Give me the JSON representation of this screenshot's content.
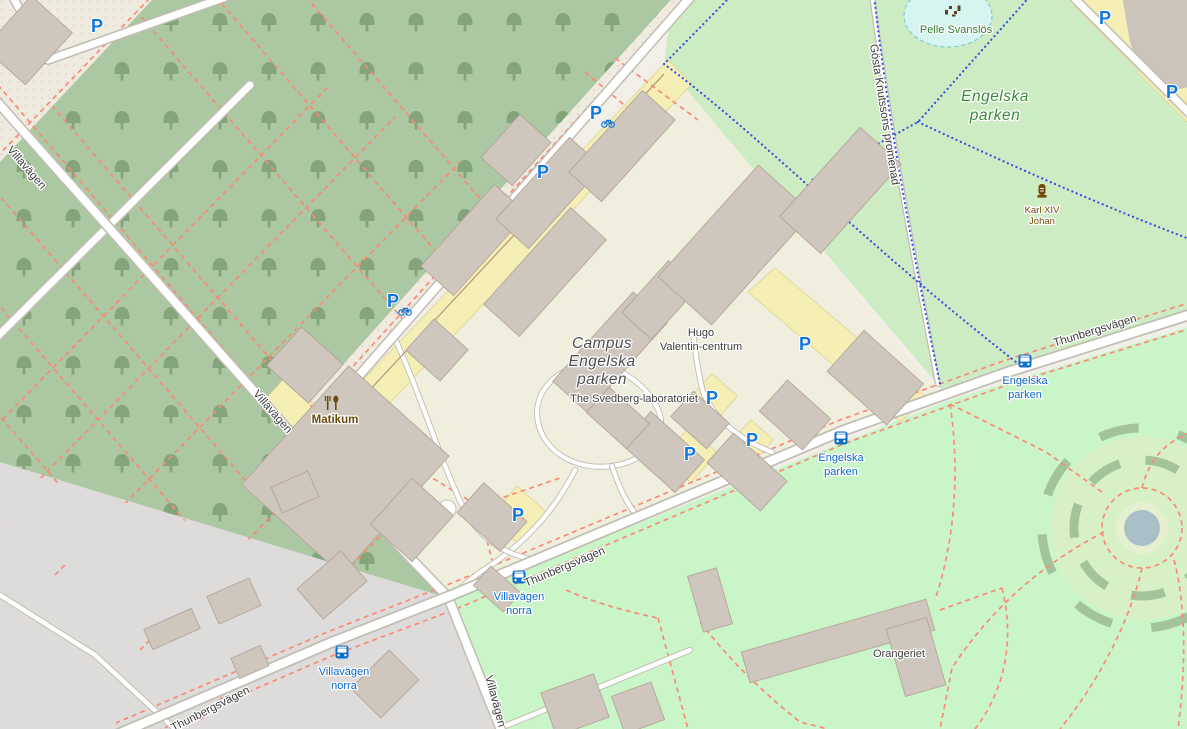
{
  "map": {
    "streets": {
      "villavagen": "Villavägen",
      "thunbergsvagen": "Thunbergsvägen",
      "gosta_knutssons_promenad": "Gösta Knutssons promenad"
    },
    "areas": {
      "engelska_parken": {
        "line1": "Engelska",
        "line2": "parken"
      },
      "campus": {
        "line1": "Campus",
        "line2": "Engelska",
        "line3": "parken"
      }
    },
    "places": {
      "pelle_svanslos": "Pelle Svanslös",
      "karl_xiv": {
        "line1": "Karl XIV",
        "line2": "Johan"
      },
      "matikum": "Matikum",
      "hugo_valentin": {
        "line1": "Hugo",
        "line2": "Valentin-centrum"
      },
      "svedberg": "The Svedberg-laboratoriet",
      "orangeriet": "Orangeriet"
    },
    "transit": {
      "engelska_parken_stop": {
        "line1": "Engelska",
        "line2": "parken"
      },
      "villavagen_norra_stop": {
        "line1": "Villavägen",
        "line2": "norra"
      }
    },
    "markers": {
      "parking": "P"
    },
    "colors": {
      "campus": "#f0eedc",
      "park": "#caf5c8",
      "green_area": "#cdecc3",
      "wood": "#abc8a2",
      "residential": "#dddcdb",
      "building": "#cfc6be",
      "parking_area": "#f6efb5",
      "water": "#d6f5f0",
      "fountain": "#a9bfc8",
      "road": "#ffffff",
      "footpath_red": "#f98a76",
      "cycleway_blue": "#3352e0",
      "transit_label_blue": "#0a66cc",
      "parking_blue": "#1177dd",
      "poi_brown": "#734a08",
      "park_label_green": "#3a8a3a"
    }
  }
}
